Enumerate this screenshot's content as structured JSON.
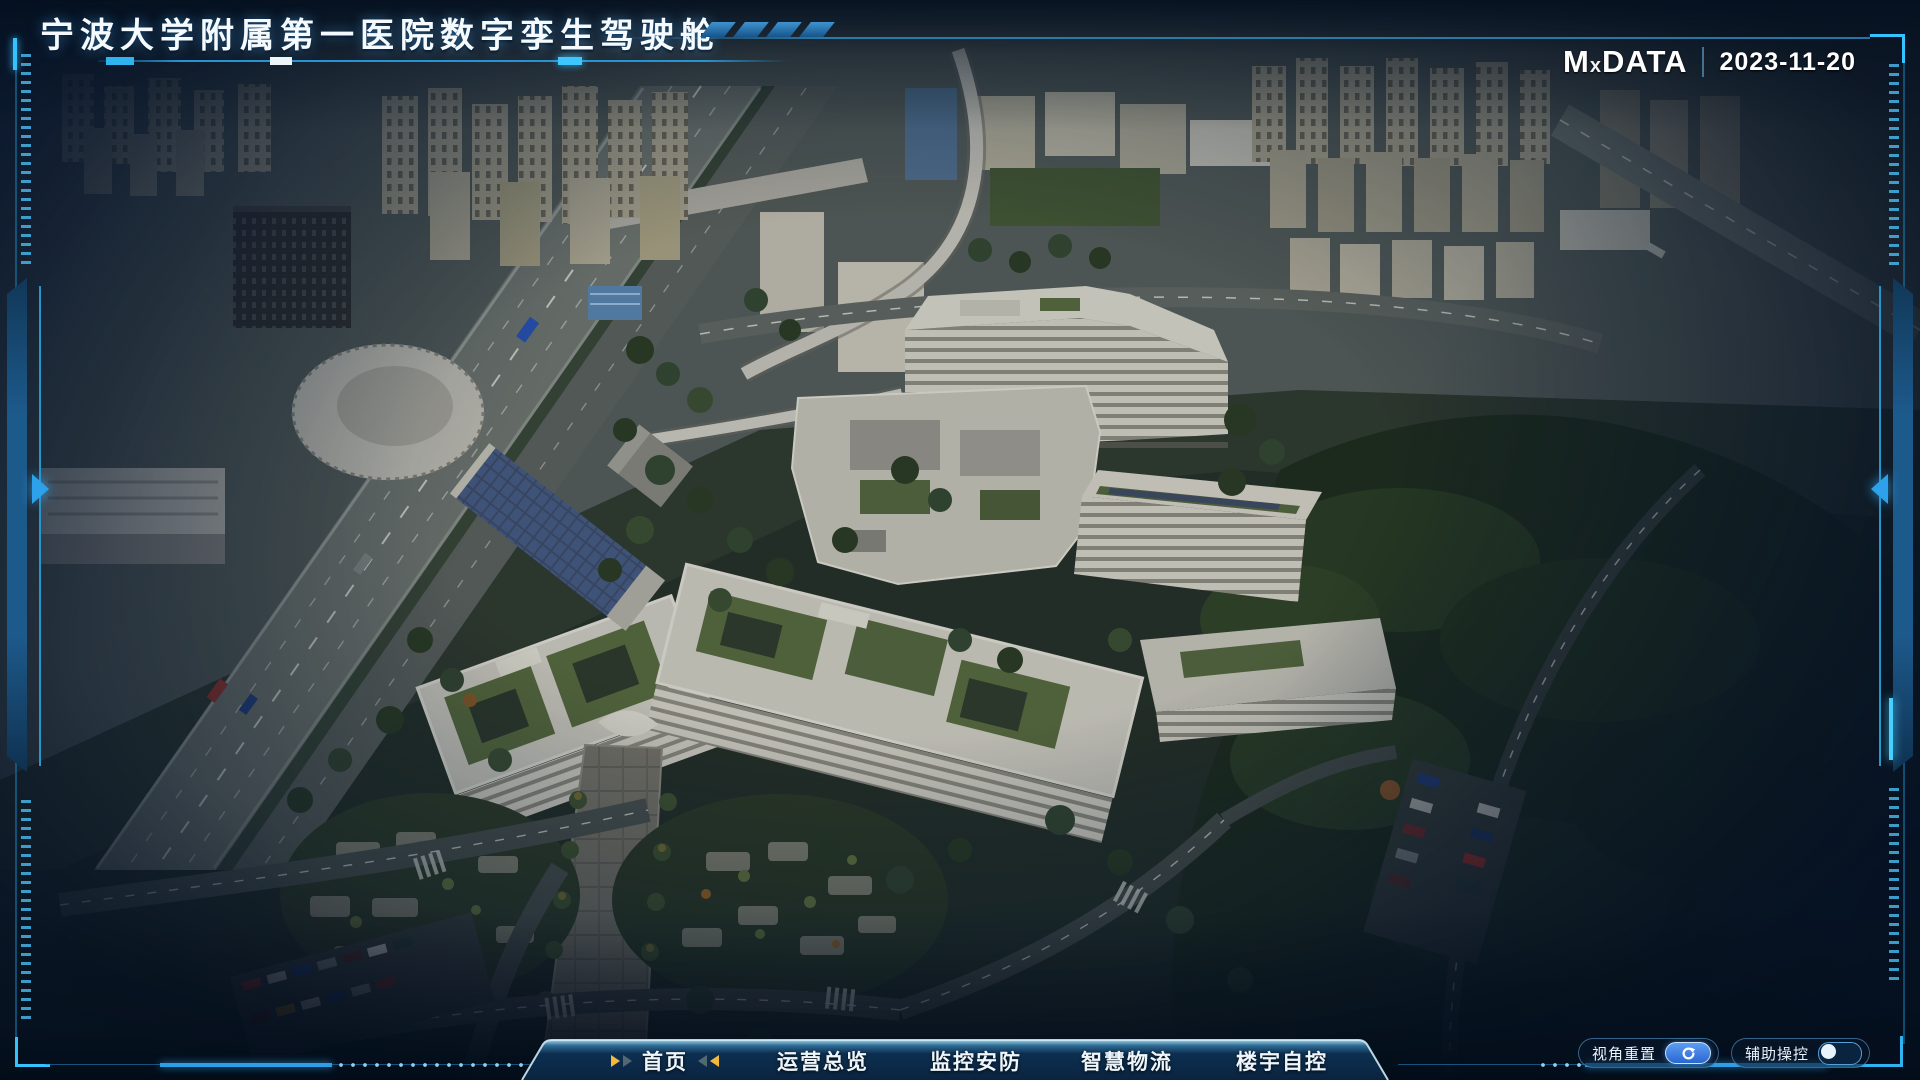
{
  "header": {
    "title": "宁波大学附属第一医院数字孪生驾驶舱",
    "brand": {
      "prefix": "M",
      "x": "x",
      "suffix": "DATA"
    },
    "date": "2023-11-20"
  },
  "nav": {
    "tabs": [
      {
        "label": "首页",
        "active": true
      },
      {
        "label": "运营总览",
        "active": false
      },
      {
        "label": "监控安防",
        "active": false
      },
      {
        "label": "智慧物流",
        "active": false
      },
      {
        "label": "楼宇自控",
        "active": false
      }
    ]
  },
  "controls": {
    "reset_view": "视角重置",
    "assist": "辅助操控",
    "assist_on": false
  },
  "colors": {
    "accent_cyan": "#35c3ff",
    "frame_blue": "#1d5a8c",
    "tab_arrow_gold": "#f2b93c",
    "button_blue": "#2a66d2",
    "background_navy": "#041222"
  }
}
